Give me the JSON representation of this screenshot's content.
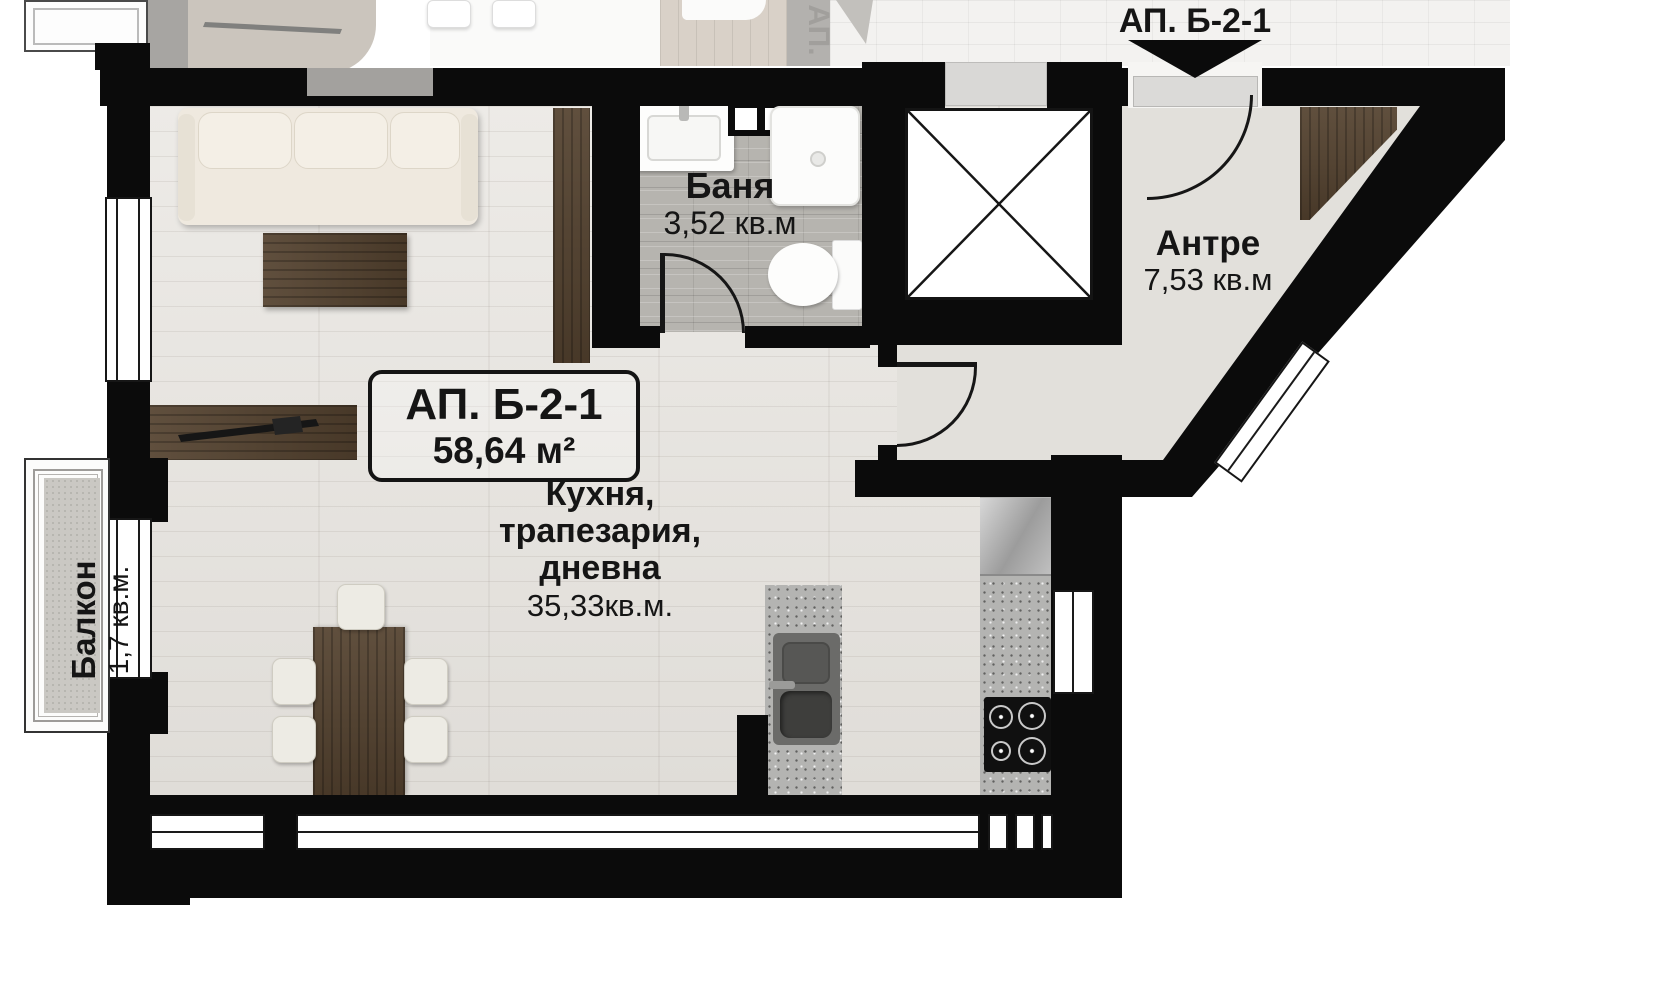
{
  "plan": {
    "entry_label": "АП. Б-2-1",
    "neighbor_entry_label": "АП.",
    "unit_card": {
      "name": "АП. Б-2-1",
      "area": "58,64 м²"
    },
    "rooms": {
      "bathroom": {
        "name": "Баня",
        "area": "3,52 кв.м"
      },
      "hall": {
        "name": "Антре",
        "area": "7,53 кв.м"
      },
      "living": {
        "line1": "Кухня,",
        "line2": "трапезария,",
        "line3": "дневна",
        "area": "35,33кв.м."
      },
      "balcony": {
        "name": "Балкон",
        "area": "1,7 кв.м."
      }
    },
    "colors": {
      "wall": "#0b0b0b",
      "wood_floor": "#e7e4df",
      "tile_floor": "#b6b4af",
      "hall_floor": "#e2e0db",
      "balcony_floor": "#cac8c3",
      "furniture_wood": "#54422f",
      "counter": "#b4b4b2",
      "fixture": "#ffffff"
    }
  }
}
